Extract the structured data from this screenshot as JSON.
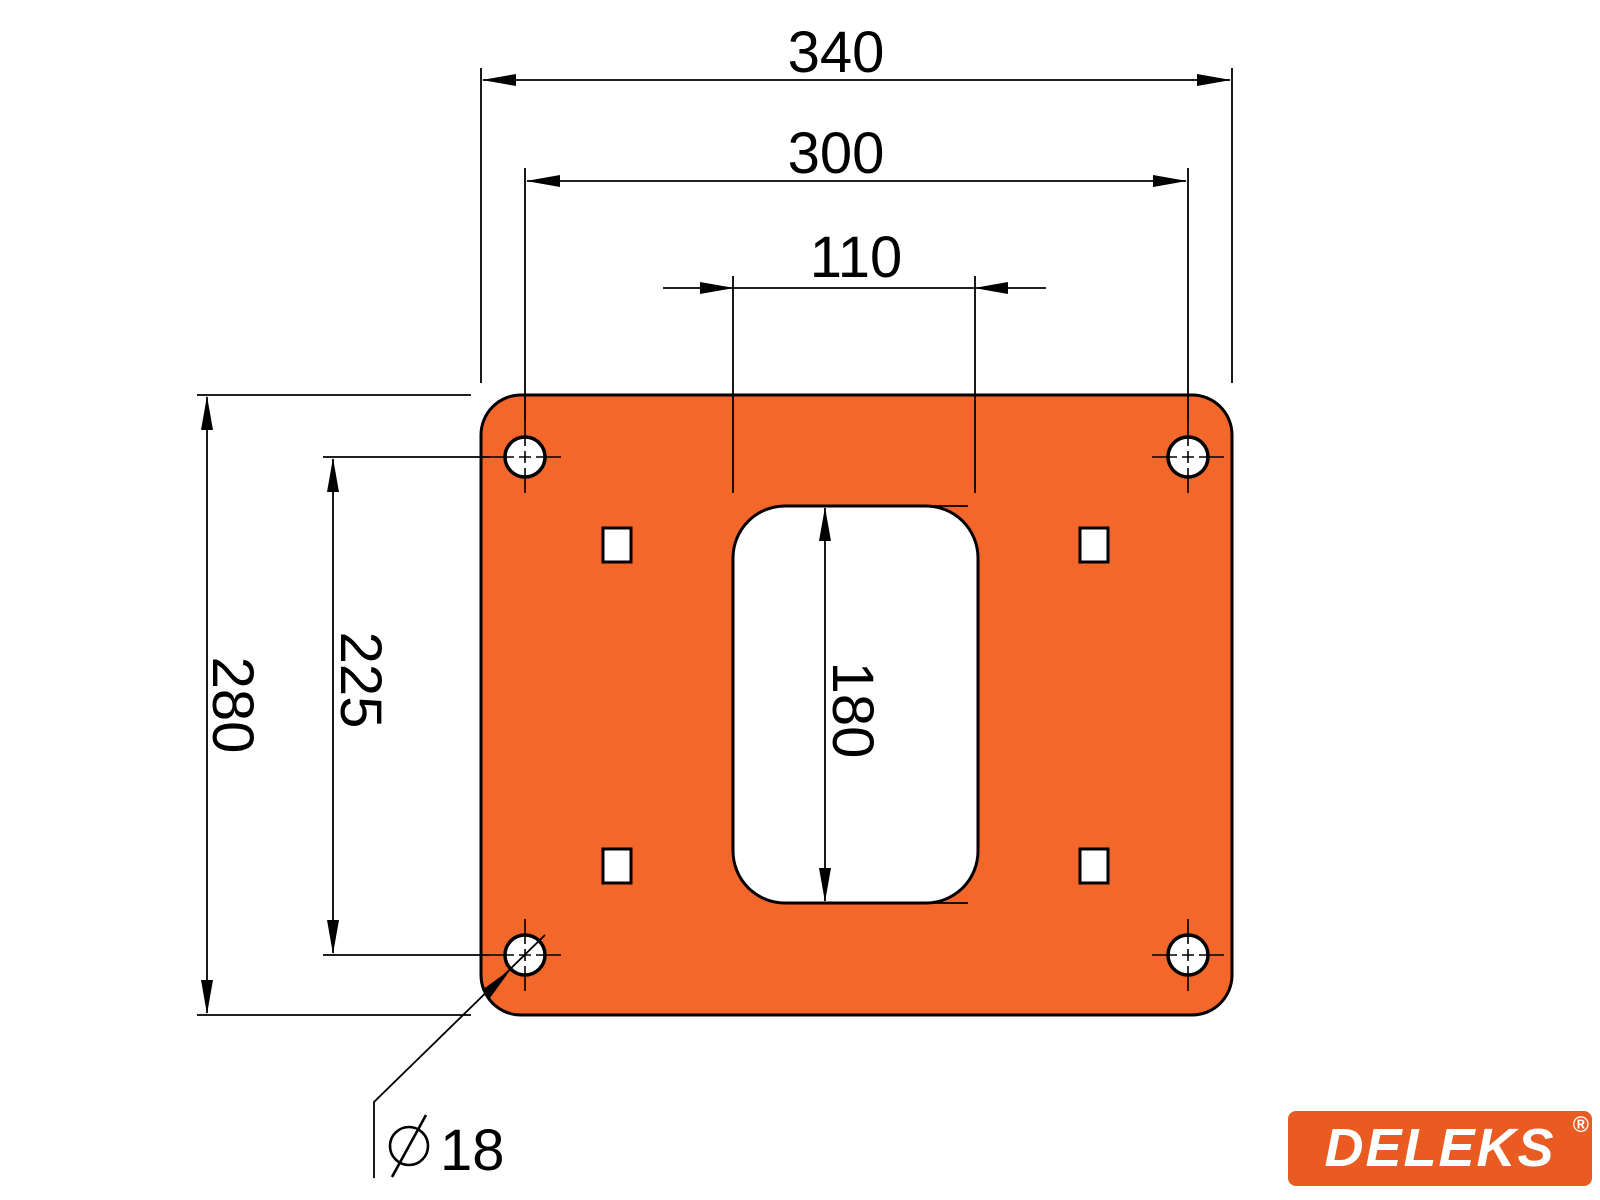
{
  "page": {
    "background": "#ffffff"
  },
  "drawing": {
    "kind": "technical-dimension-drawing",
    "subject": "orange mounting plate, front view",
    "line_color": "#000000",
    "plate_color": "#F4672A",
    "dimensions": {
      "overall_width": "340",
      "bolt_spacing_horizontal": "300",
      "slot_width": "110",
      "overall_height": "280",
      "bolt_spacing_vertical": "225",
      "slot_height": "180",
      "bolt_hole_diameter_value": "18",
      "bolt_hole_diameter_label": "Ø18"
    },
    "features": {
      "corner_bolt_holes": 4,
      "square_cutouts": 4,
      "central_slot": 1
    }
  },
  "logo": {
    "brand": "DELEKS",
    "registered": "®",
    "background": "#EA5B22",
    "text_color": "#ffffff"
  }
}
